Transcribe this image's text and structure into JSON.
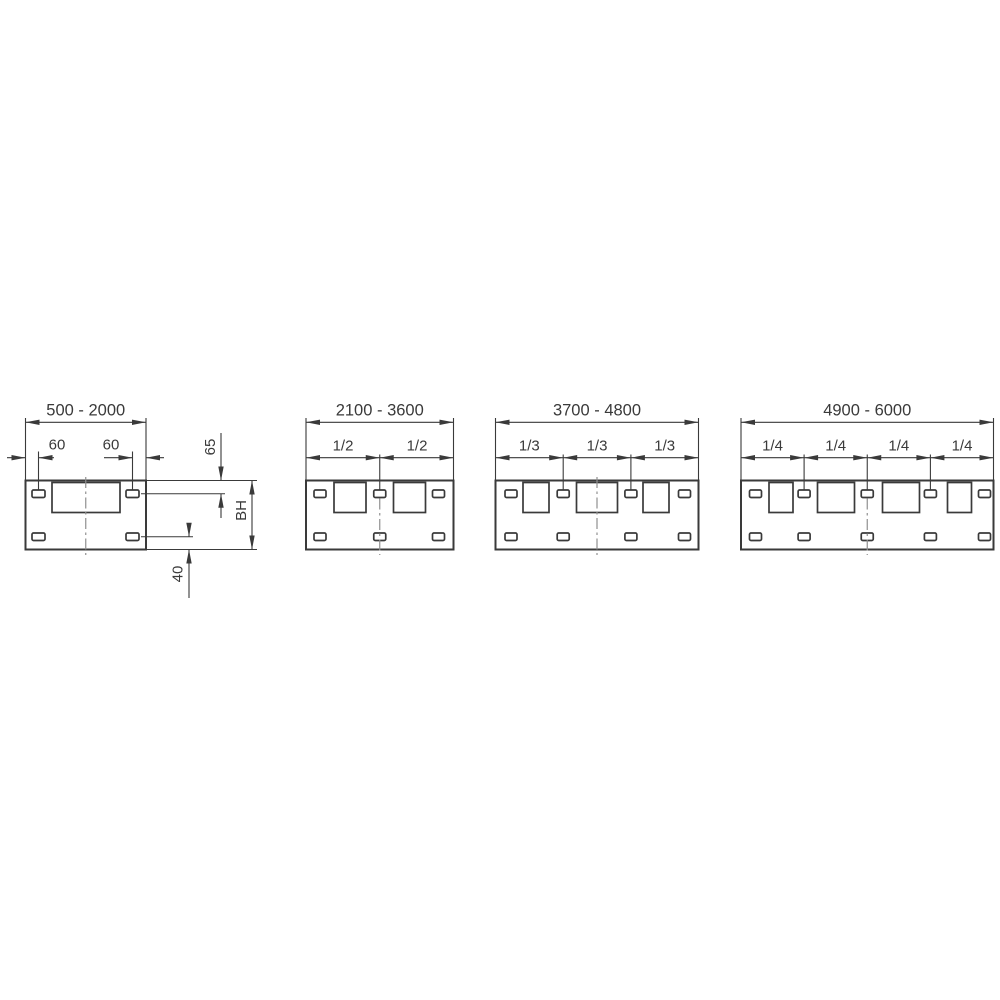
{
  "drawing": {
    "background": "#ffffff",
    "line_color": "#3a3a3a",
    "centerline_color": "#8f8f8f"
  },
  "diagrams": [
    {
      "name": "panel-width-500-2000",
      "width_range": "500 - 2000",
      "left_slot_offset": "60",
      "right_slot_offset": "60",
      "top_slot_offset": "65",
      "height_label": "BH",
      "bottom_slot_offset": "40"
    },
    {
      "name": "panel-width-2100-3600",
      "width_range": "2100 - 3600",
      "divisions": [
        "1/2",
        "1/2"
      ]
    },
    {
      "name": "panel-width-3700-4800",
      "width_range": "3700 - 4800",
      "divisions": [
        "1/3",
        "1/3",
        "1/3"
      ]
    },
    {
      "name": "panel-width-4900-6000",
      "width_range": "4900 - 6000",
      "divisions": [
        "1/4",
        "1/4",
        "1/4",
        "1/4"
      ]
    }
  ]
}
